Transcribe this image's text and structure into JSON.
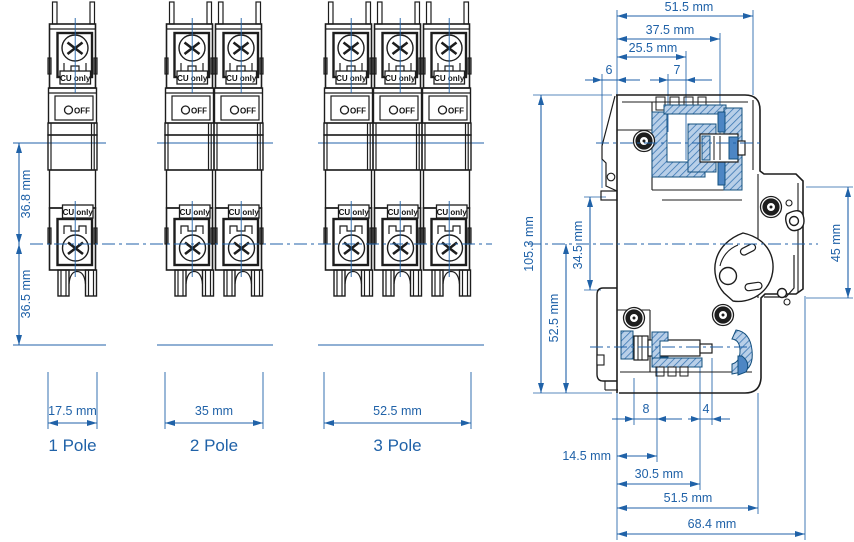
{
  "drawing": {
    "type": "circuit-breaker dimensional drawing",
    "colors": {
      "dimension_blue": "#2062a8",
      "line_black": "#1d1d1d",
      "hatch_fill": "#b8cfe8",
      "hatch_line": "#3b77b3",
      "solid_blue": "#4d86c4",
      "background": "#ffffff"
    }
  },
  "front": {
    "upper_height": "36.8 mm",
    "lower_height": "36.5 mm",
    "views": [
      {
        "label": "1 Pole",
        "width": "17.5 mm"
      },
      {
        "label": "2 Pole",
        "width": "35 mm"
      },
      {
        "label": "3 Pole",
        "width": "52.5 mm"
      }
    ],
    "module": {
      "terminal_label": "CU only",
      "switch_label": "OFF"
    }
  },
  "side": {
    "top_width": "51.5 mm",
    "terminal_depth": "37.5 mm",
    "screw_depth": "25.5 mm",
    "rear_offset": "6",
    "opening_width": "7",
    "overall_height": "105.3 mm",
    "rail_span": "34.5 mm",
    "lower_height": "52.5 mm",
    "front_height": "45 mm",
    "screw_offset": "8",
    "clearance": "4",
    "clip_depth": "14.5 mm",
    "lower_depth": "30.5 mm",
    "bottom_width": "51.5 mm",
    "overall_depth": "68.4 mm"
  }
}
